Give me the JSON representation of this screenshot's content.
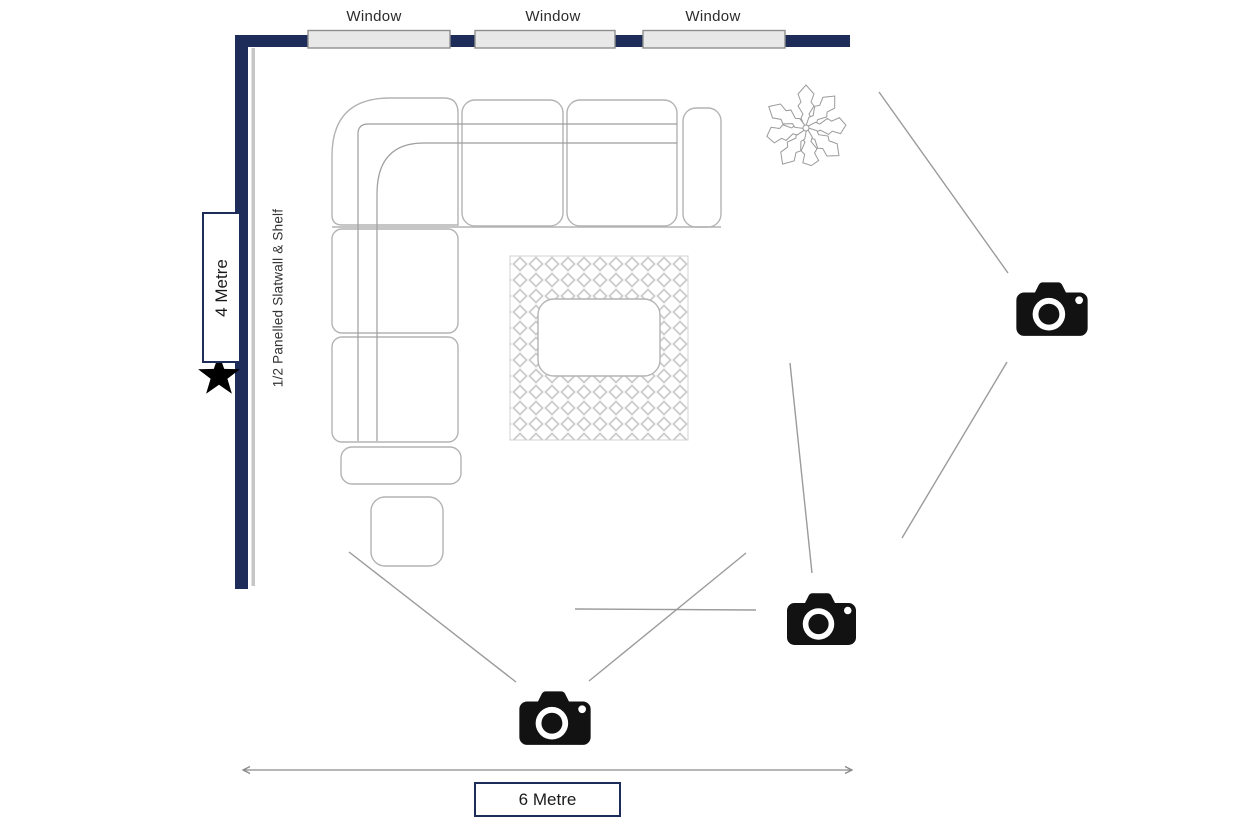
{
  "diagram": {
    "type": "floor-plan",
    "room_width_label": "6 Metre",
    "room_height_label": "4 Metre",
    "wall_note": "1/2 Panelled Slatwall & Shelf",
    "windows": [
      "Window",
      "Window",
      "Window"
    ],
    "furniture": [
      "corner-sofa",
      "ottoman",
      "rug",
      "coffee-table",
      "plant"
    ],
    "markers": {
      "camera_count": 3,
      "star_count": 1
    }
  },
  "colors": {
    "wall": "#1d2c58",
    "window_fill": "#e8e8e8",
    "window_border": "#8f8f8f",
    "furniture_outline": "#b3b3b3",
    "sight_line": "#9b9b9b",
    "camera": "#121212",
    "star": "#000000",
    "text": "#222222"
  }
}
